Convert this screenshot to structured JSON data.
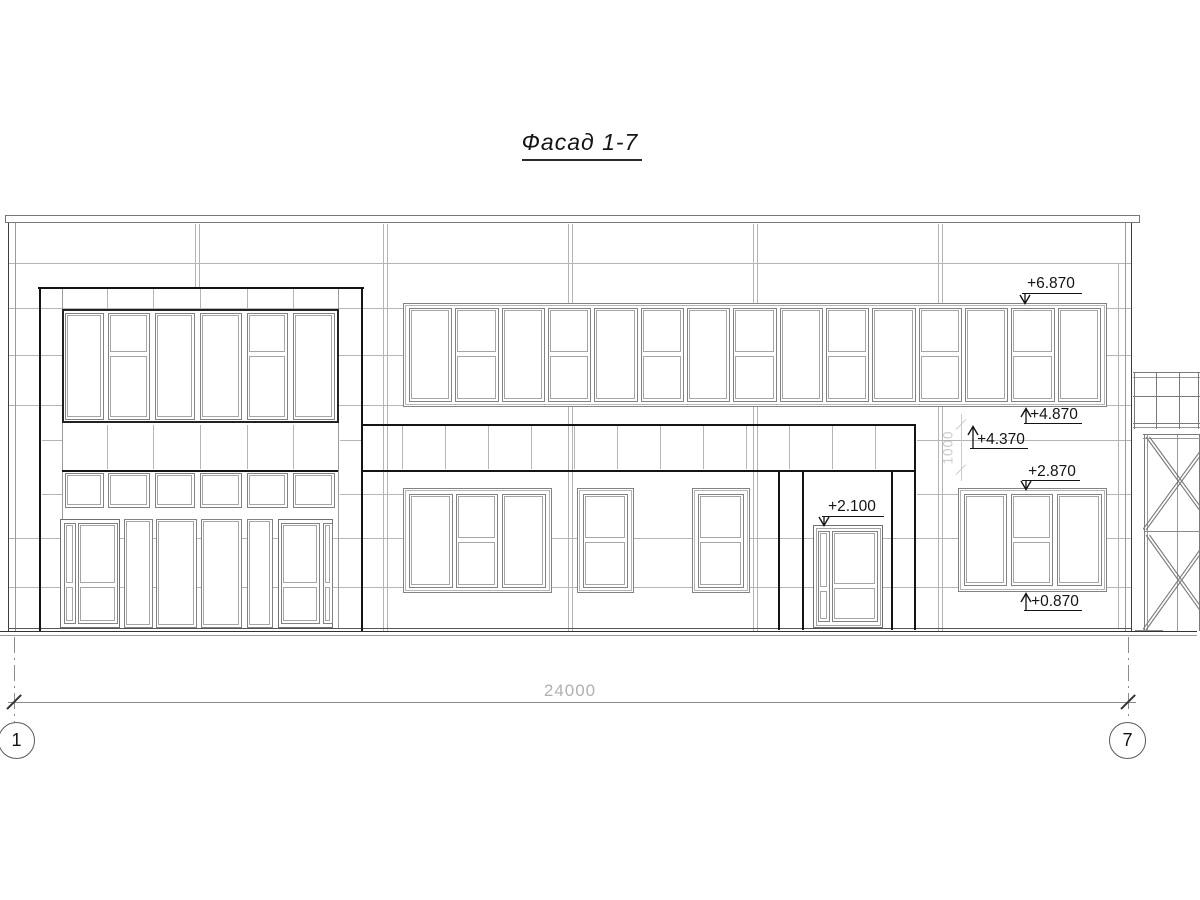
{
  "title": "Фасад 1-7",
  "axis_bubbles": {
    "left": "1",
    "right": "7"
  },
  "dimensions": {
    "overall_width": "24000",
    "band_height": "1000"
  },
  "elevations": [
    {
      "name": "upper-window-head",
      "value": "+6.870"
    },
    {
      "name": "upper-window-sill",
      "value": "+4.870"
    },
    {
      "name": "band-top",
      "value": "+4.370"
    },
    {
      "name": "lower-window-head",
      "value": "+2.870"
    },
    {
      "name": "lower-window-sill",
      "value": "+0.870"
    },
    {
      "name": "entrance-door-head",
      "value": "+2.100"
    }
  ],
  "colors": {
    "background": "#ffffff",
    "line_thick": "#141414",
    "line_dark": "#3d3d3d",
    "line_medium": "#7a7a7a",
    "frame_gray": "#828282",
    "sash_gray": "#a5a5a5",
    "line_light": "#b5b5b5",
    "dim_text": "#b0b0b0",
    "watermark": "#cccccc"
  }
}
